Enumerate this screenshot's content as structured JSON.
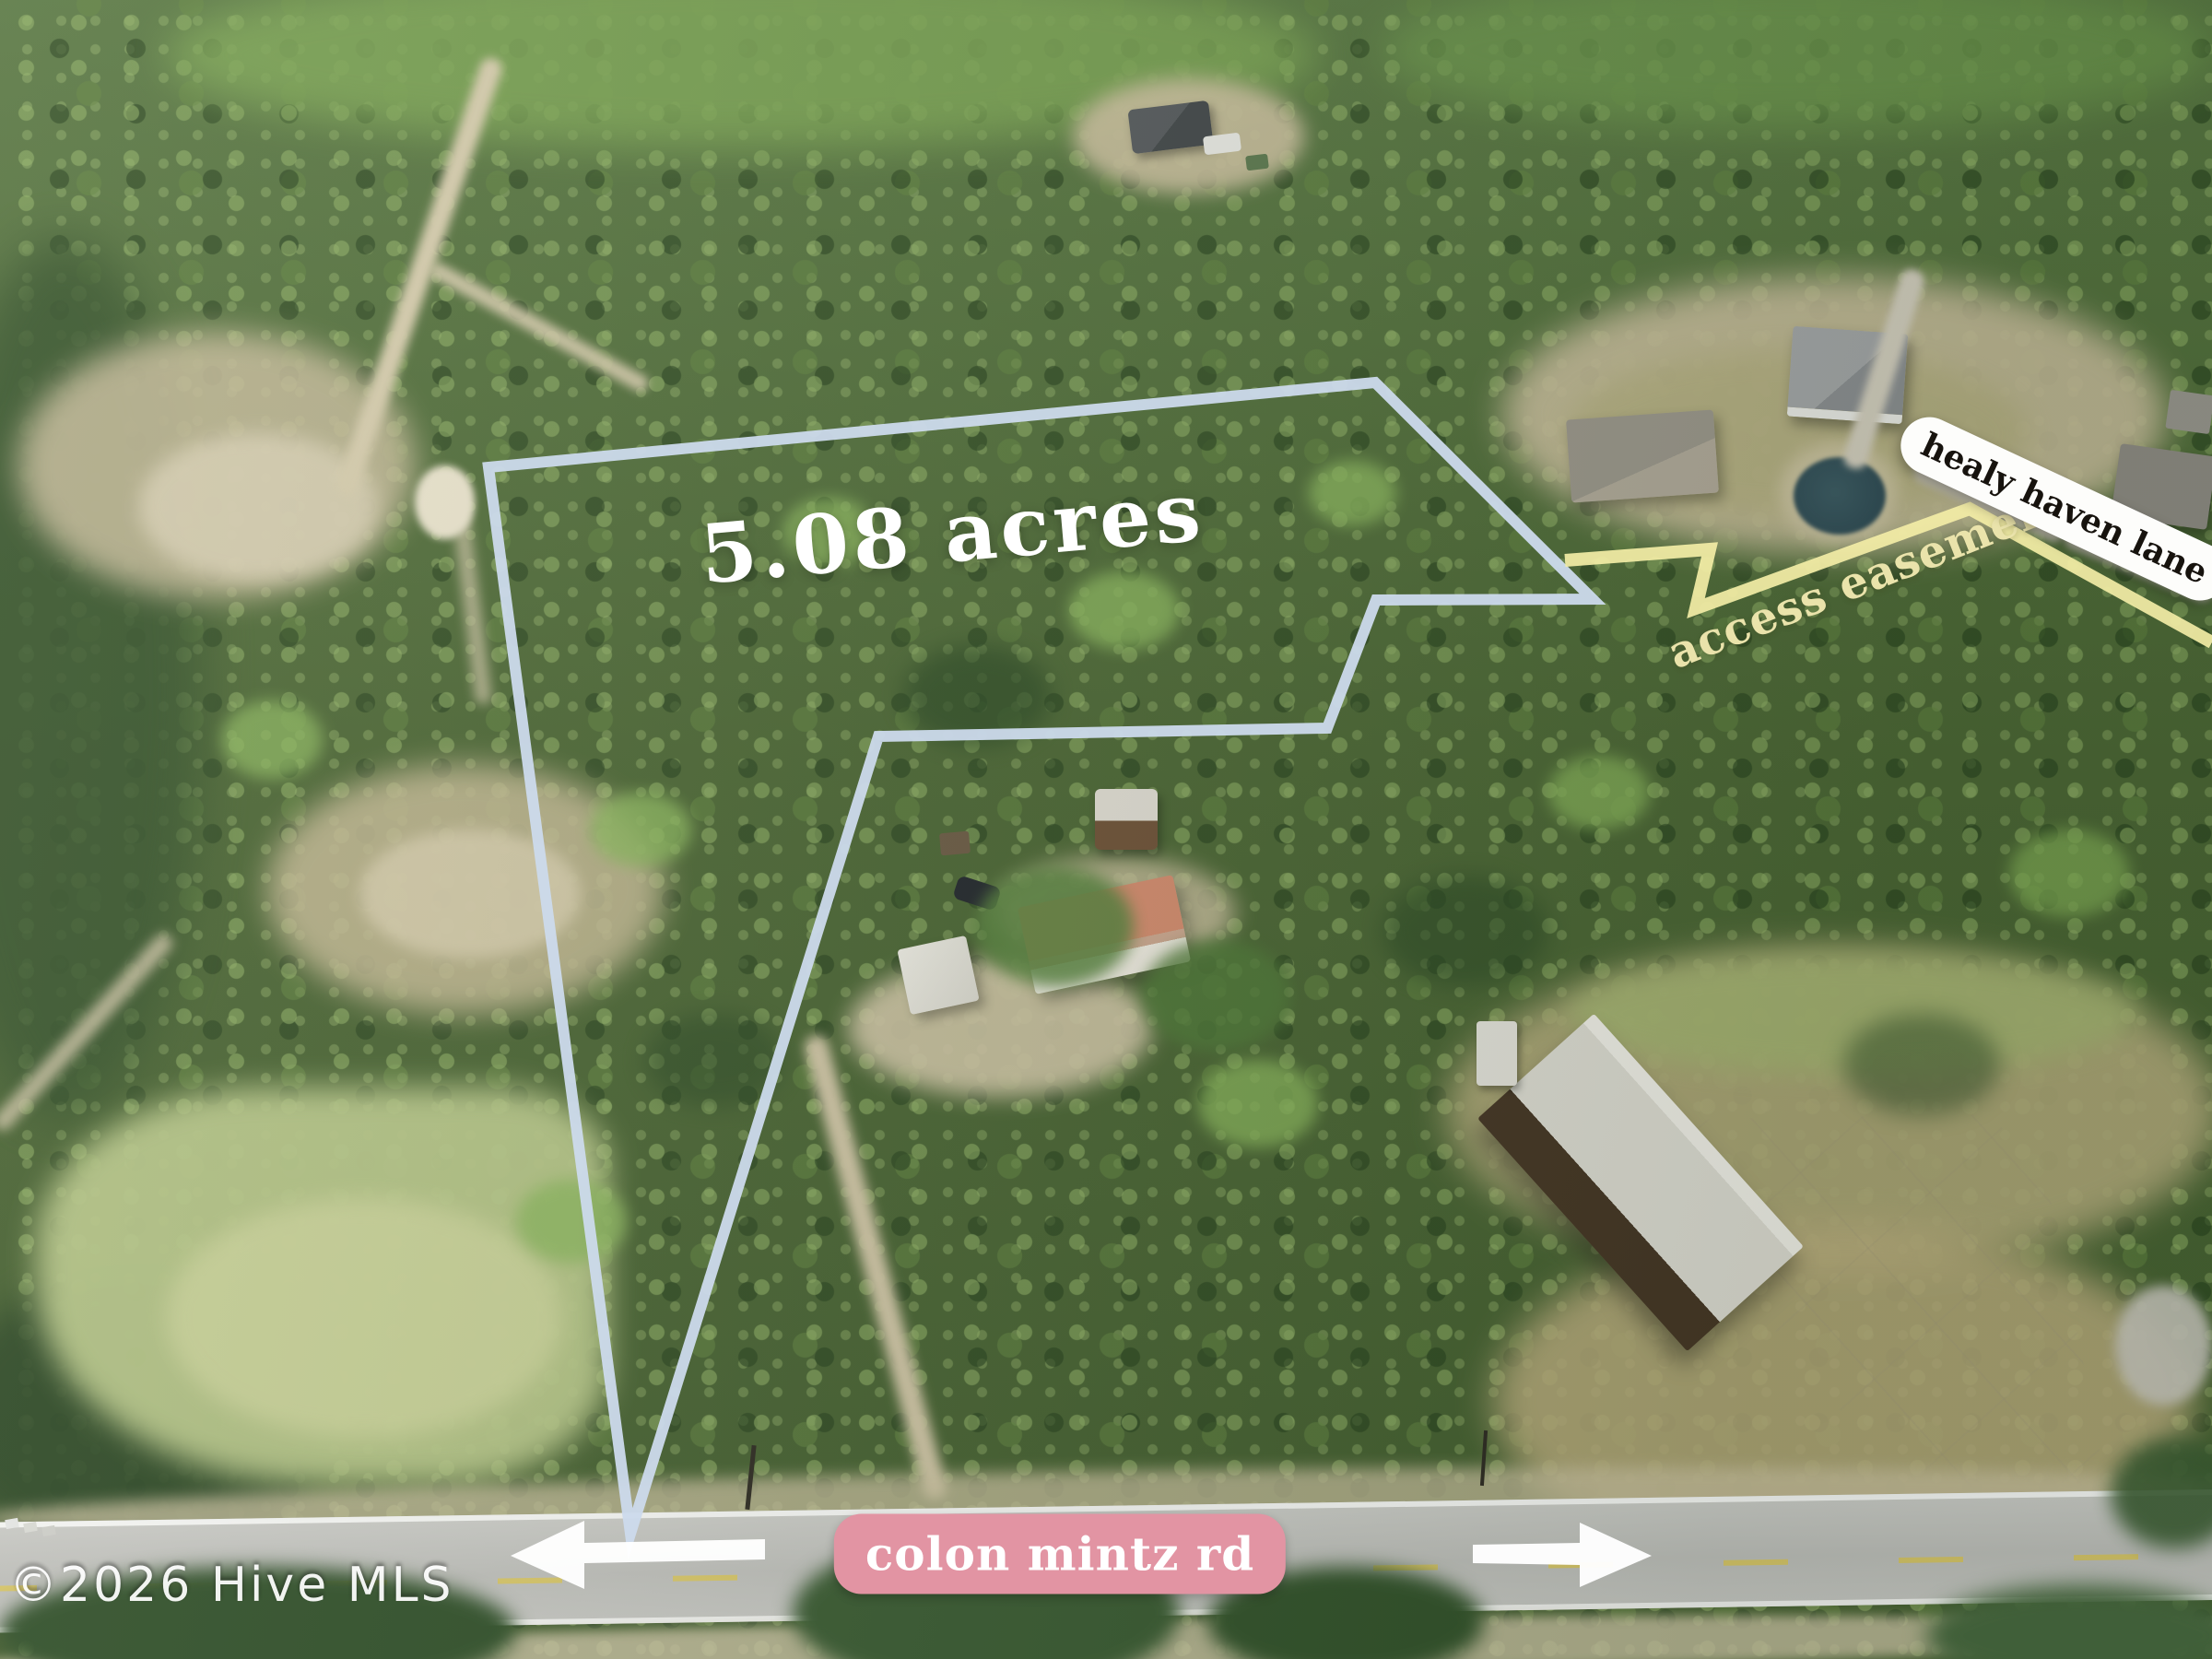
{
  "annotations": {
    "acreage_label": "5.08 acres",
    "easement_label": "access easement",
    "street_sign_label": "healy haven lane",
    "road_label": "colon mintz rd",
    "watermark": "©2026 Hive MLS"
  },
  "overlay": {
    "boundary_points": "530,507 1492,415 1728,650 1493,651 1440,790 953,799 684,1664",
    "easement_points": "1698,608 1855,596 1840,660 2137,552 2400,697",
    "arrow_left_points": "554,1688 634,1650 634,1674 830,1670 830,1692 634,1696 634,1724",
    "arrow_right_points": "1792,1688 1714,1652 1714,1674 1598,1676 1598,1696 1714,1698 1714,1722"
  },
  "colors": {
    "boundary": "#ccdaec",
    "easement_line": "#f3eda6",
    "easement_text": "#eae3ab",
    "arrow": "#ffffff",
    "acreage_text": "#ffffff",
    "street_sign_bg": "#fdfdfb",
    "street_sign_text": "#17130e",
    "road_label_bg": "#e294a3",
    "road_label_text": "#ffffff",
    "watermark_text": "#ffffff"
  }
}
